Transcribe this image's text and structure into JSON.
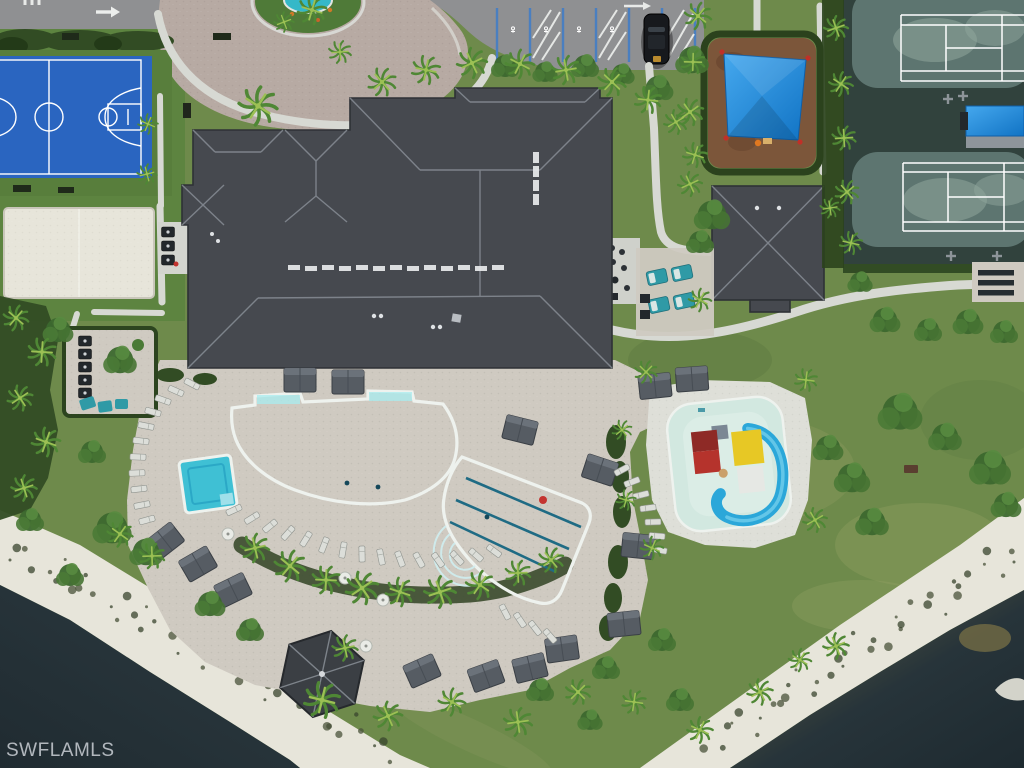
{
  "watermark": {
    "text": "SWFLAMLS"
  },
  "scene": {
    "type": "aerial-photo",
    "description": "Overhead drone photograph of a community amenity campus: clubhouse with charcoal hip roof, circular paver entry drive with island fountain, accessible parking row with one parked black SUV, blue basketball court, sand volleyball court, playground with blue shade sail, two tennis courts with blue shade canopy, resort pool with tanning ledges, spa, three-lane lap pool, splash pad with blue water slide, lounge chairs, cabanas, gazebo, palm landscaping, white sand lake shoreline and dark lake water at the lower corners.",
    "features": [
      {
        "name": "basketball-court",
        "label": "Basketball court"
      },
      {
        "name": "sand-volleyball-court",
        "label": "Sand volleyball court"
      },
      {
        "name": "circular-driveway",
        "label": "Circular paver driveway with fountain island"
      },
      {
        "name": "accessible-parking",
        "label": "Accessible parking stalls"
      },
      {
        "name": "parked-suv",
        "label": "Parked black SUV"
      },
      {
        "name": "clubhouse-roof",
        "label": "Clubhouse"
      },
      {
        "name": "pavilion-roof",
        "label": "Restroom pavilion"
      },
      {
        "name": "playground-shade-sail",
        "label": "Playground with blue shade sail"
      },
      {
        "name": "tennis-courts",
        "label": "Tennis courts"
      },
      {
        "name": "tennis-shade-canopy",
        "label": "Court-side shade canopy"
      },
      {
        "name": "resort-pool",
        "label": "Resort-style pool"
      },
      {
        "name": "spa",
        "label": "Spa"
      },
      {
        "name": "lap-pool",
        "label": "Lap pool (3 lanes)"
      },
      {
        "name": "splash-pad",
        "label": "Splash pad with water slide"
      },
      {
        "name": "gazebo",
        "label": "Gazebo"
      },
      {
        "name": "lake-shoreline",
        "label": "Lake with white sand shoreline"
      }
    ]
  },
  "colors": {
    "asphalt": "#8f9092",
    "paver_drive": "#b7aaa3",
    "path_concrete": "#d7d9d3",
    "deck_paver": "#cfcac1",
    "splash_deck": "#dedfd8",
    "roof": "#46494f",
    "roof_ridge": "#878d95",
    "roof_edge": "#2e3136",
    "hedge": "#324c24",
    "grass_base": "#6e8a4b",
    "grass_sat": "#5d8440",
    "court_blue": "#2a65c0",
    "sand": "#e7e5da",
    "tennis_dark": "#31423d",
    "tennis_surface": "#5d7570",
    "tennis_worn": "#90a59c",
    "mulch": "#7c563a",
    "sail_blue": "#1e8ee2",
    "pool_light": "#6fdbe6",
    "pool_deep": "#1f9ec0",
    "coping": "#eef2ee",
    "lane_line": "#1f6b84",
    "splash_pool": "#d2e8e0",
    "slide_blue": "#2ba7d9",
    "play_red": "#b5332c",
    "play_yellow": "#e7c825",
    "water_dark": "#27343a",
    "water_olive": "#4f5a3a",
    "water_amber": "#6f6a42",
    "palm_green": "#4f8735",
    "palm_light": "#9cc054",
    "teal_furniture": "#2f9aa6",
    "car_black": "#17191d",
    "stall_blue": "#4a7fc0",
    "watermark": "#c6cbd1"
  }
}
